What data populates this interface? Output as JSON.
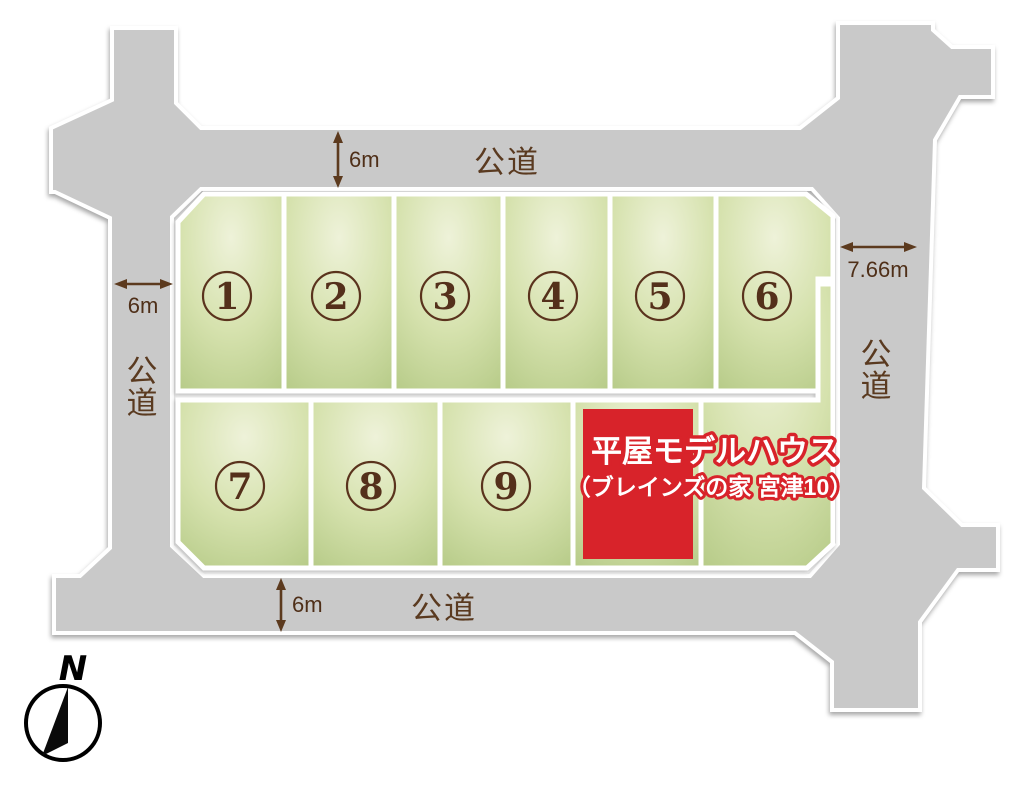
{
  "diagram": {
    "type": "land-lot-subdivision-map",
    "lots": [
      {
        "id": 1,
        "label": "1"
      },
      {
        "id": 2,
        "label": "2"
      },
      {
        "id": 3,
        "label": "3"
      },
      {
        "id": 4,
        "label": "4"
      },
      {
        "id": 5,
        "label": "5"
      },
      {
        "id": 6,
        "label": "6"
      },
      {
        "id": 7,
        "label": "7"
      },
      {
        "id": 8,
        "label": "8"
      },
      {
        "id": 9,
        "label": "9"
      }
    ],
    "model_house": {
      "title": "平屋モデルハウス",
      "subtitle": "（ブレインズの家 宮津10）"
    },
    "roads": {
      "top": {
        "label": "公道",
        "width": "6m"
      },
      "left": {
        "label": "公道",
        "width": "6m"
      },
      "right": {
        "label": "公道",
        "width": "7.66m"
      },
      "bottom": {
        "label": "公道",
        "width": "6m"
      }
    },
    "compass": {
      "label": "N"
    },
    "colors": {
      "road": "#c9c9c9",
      "lot_light": "#eef2d9",
      "lot_dark": "#b4c985",
      "accent_red": "#d8232a",
      "text_brown": "#5a3a20",
      "number_brown": "#54301b"
    }
  }
}
